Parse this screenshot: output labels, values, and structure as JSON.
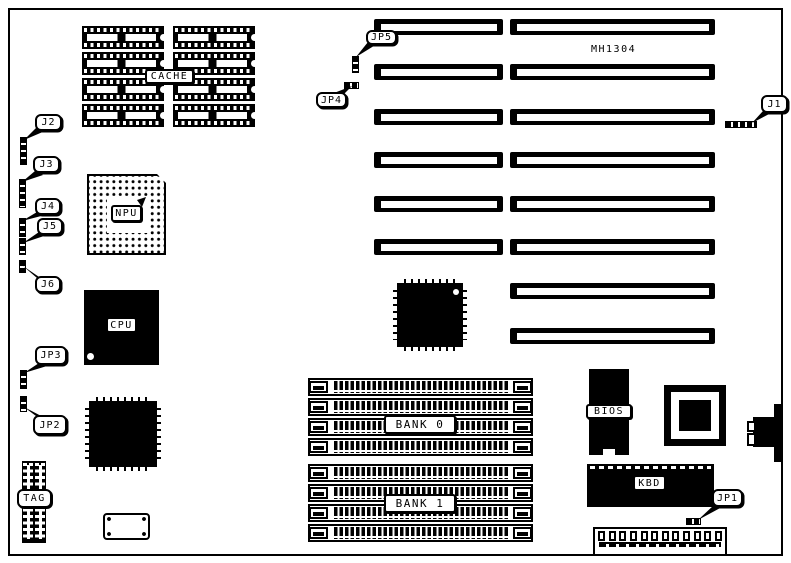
{
  "diagram": {
    "board_model": "MH1304",
    "chip_labels": {
      "cache": "CACHE",
      "npu": "NPU",
      "cpu": "CPU",
      "tag": "TAG",
      "bank0": "BANK 0",
      "bank1": "BANK 1",
      "bios": "BIOS",
      "kbd": "KBD"
    },
    "jumper_labels": {
      "j1": "J1",
      "j2": "J2",
      "j3": "J3",
      "j4": "J4",
      "j5": "J5",
      "j6": "J6",
      "jp1": "JP1",
      "jp2": "JP2",
      "jp3": "JP3",
      "jp4": "JP4",
      "jp5": "JP5"
    },
    "colors": {
      "ink": "#000000",
      "paper": "#ffffff"
    }
  }
}
